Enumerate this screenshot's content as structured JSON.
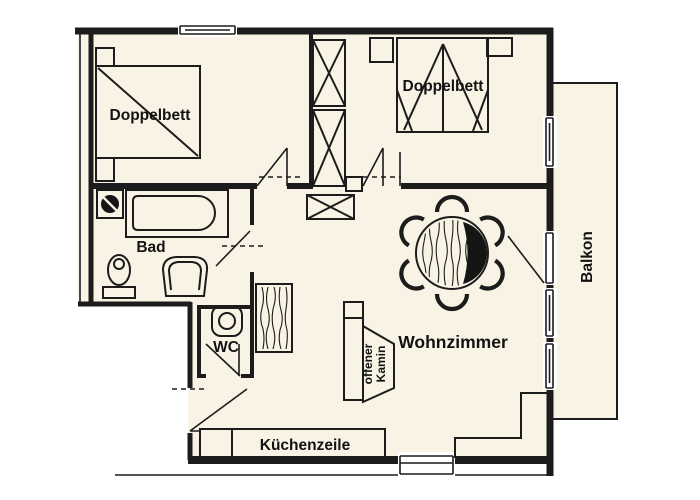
{
  "colors": {
    "background": "#ffffff",
    "floor": "#f9f3e5",
    "line": "#1c1c1c",
    "table_dark": "#151515"
  },
  "rooms": {
    "bedroom1": {
      "label": "Doppelbett"
    },
    "bedroom2": {
      "label": "Doppelbett"
    },
    "bathroom": {
      "label": "Bad"
    },
    "wc": {
      "label": "WC"
    },
    "living_room": {
      "label": "Wohnzimmer"
    },
    "kitchen": {
      "label": "Küchenzeile"
    },
    "balcony": {
      "label": "Balkon"
    },
    "fireplace": {
      "label_line1": "offener",
      "label_line2": "Kamin"
    }
  }
}
